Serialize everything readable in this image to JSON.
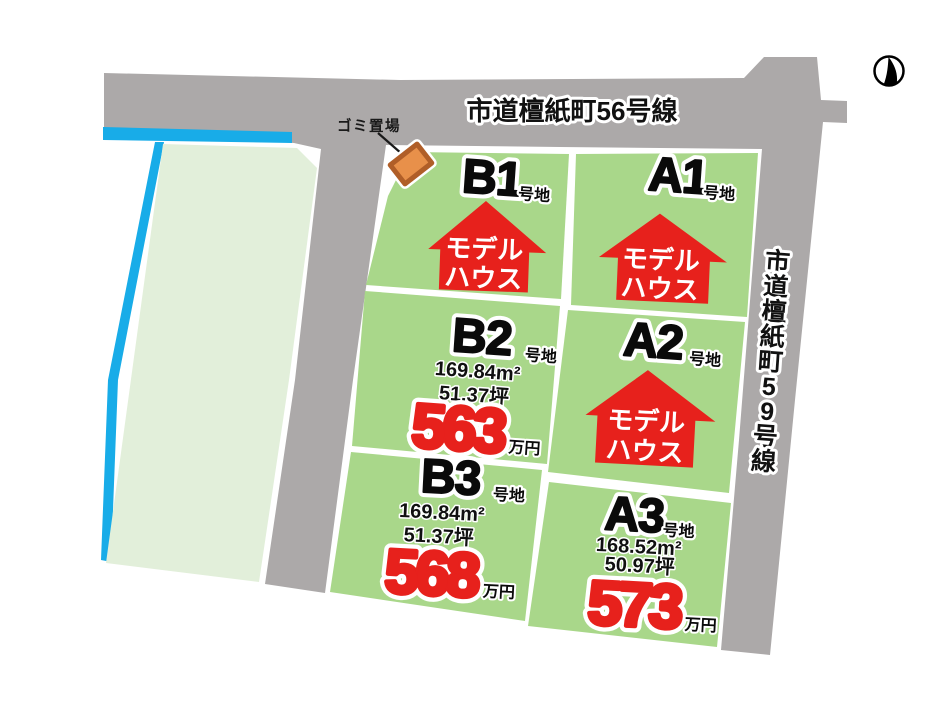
{
  "map": {
    "colors": {
      "road": "#ACA9A9",
      "lot_green": "#A9D78A",
      "adjacent_field": "#E2EFDA",
      "water": "#18ACE8",
      "accent_red": "#E7211C",
      "marker_orange": "#E8904A",
      "marker_border": "#B05E28"
    },
    "roads": {
      "top": {
        "label": "市道檀紙町56号線"
      },
      "right": {
        "label": "市道檀紙町59号線",
        "chars": [
          "市",
          "道",
          "檀",
          "紙",
          "町",
          "5",
          "9",
          "号",
          "線"
        ]
      }
    },
    "garbage_site": {
      "label": "ゴミ置場"
    },
    "lots": [
      {
        "id": "B1",
        "suffix": "号地",
        "model_house": {
          "line1": "モデル",
          "line2": "ハウス"
        }
      },
      {
        "id": "A1",
        "suffix": "号地",
        "model_house": {
          "line1": "モデル",
          "line2": "ハウス"
        }
      },
      {
        "id": "B2",
        "suffix": "号地",
        "area_m2": "169.84m²",
        "area_tsubo": "51.37坪",
        "price": "563",
        "price_unit": "万円"
      },
      {
        "id": "A2",
        "suffix": "号地",
        "model_house": {
          "line1": "モデル",
          "line2": "ハウス"
        }
      },
      {
        "id": "B3",
        "suffix": "号地",
        "area_m2": "169.84m²",
        "area_tsubo": "51.37坪",
        "price": "568",
        "price_unit": "万円"
      },
      {
        "id": "A3",
        "suffix": "号地",
        "area_m2": "168.52m²",
        "area_tsubo": "50.97坪",
        "price": "573",
        "price_unit": "万円"
      }
    ]
  }
}
